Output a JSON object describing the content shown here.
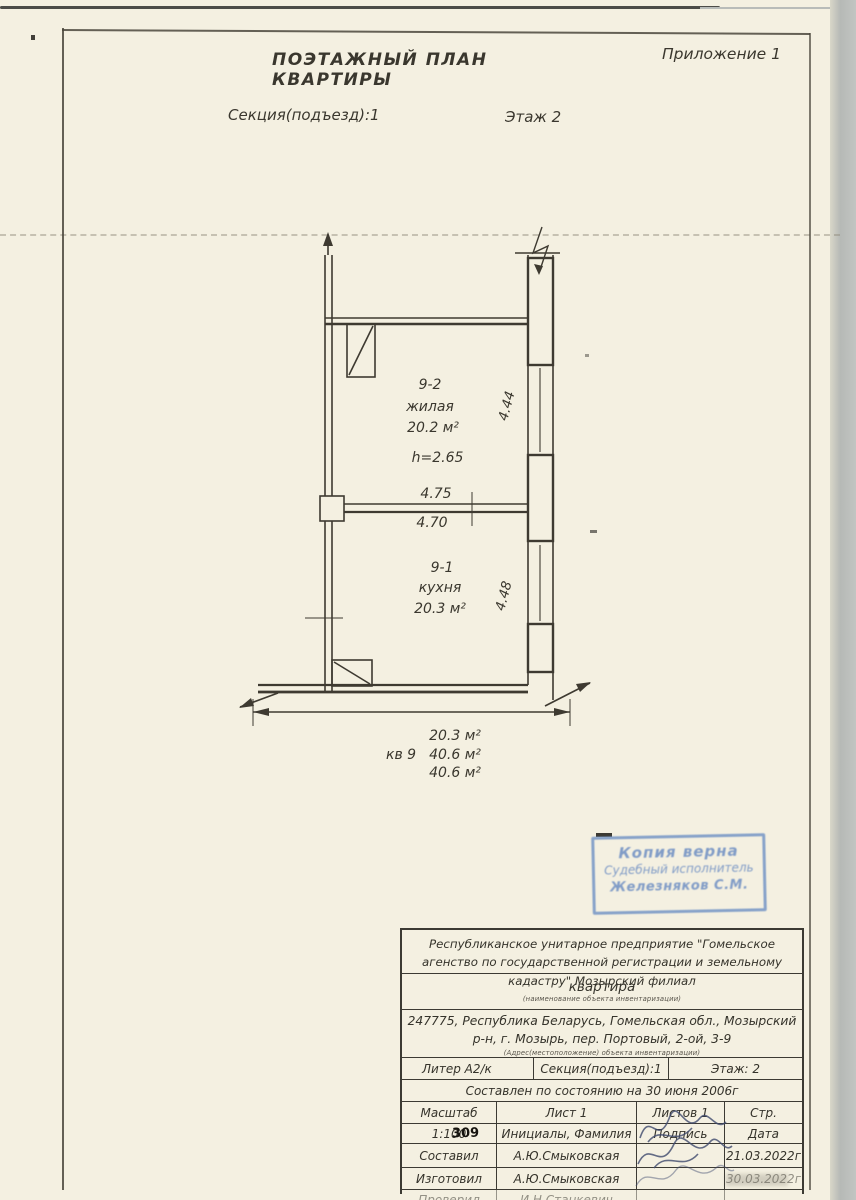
{
  "header": {
    "annex": "Приложение 1",
    "title": "ПОЭТАЖНЫЙ ПЛАН КВАРТИРЫ",
    "section": "Секция(подъезд):1",
    "floor": "Этаж 2"
  },
  "plan": {
    "room_top": {
      "number": "9-2",
      "name": "жилая",
      "area": "20.2 м²",
      "ceiling_height": "h=2.65"
    },
    "room_bottom": {
      "number": "9-1",
      "name": "кухня",
      "area": "20.3 м²"
    },
    "dimensions": {
      "partition_top": "4.75",
      "partition_bottom": "4.70",
      "right_upper": "4.44",
      "right_lower": "4.48"
    },
    "totals": {
      "kitchen_area": "20.3 м²",
      "apartment_label": "кв 9",
      "apartment_area": "40.6 м²",
      "total_area": "40.6 м²"
    }
  },
  "stamp": {
    "line1": "Копия верна",
    "line2": "Судебный исполнитель",
    "line3": "Железняков С.М.",
    "ink_color": "#7e9cc8"
  },
  "info_table": {
    "organization": "Республиканское унитарное предприятие \"Гомельское агенство по государственной регистрации и земельному кадастру\" Мозырский филиал",
    "object_type": "квартира",
    "object_type_caption": "(наименование объекта инвентаризации)",
    "address": "247775, Республика Беларусь, Гомельская обл., Мозырский р-н, г. Мозырь, пер. Портовый, 2-ой, 3-9",
    "address_caption": "(Адрес(местоположение) объекта инвентаризации)",
    "liter": "Литер А2/к",
    "section": "Секция(подъезд):1",
    "floor": "Этаж: 2",
    "status_line": "Составлен по состоянию на 30 июня 2006г",
    "col_headers": {
      "scale": "Масштаб",
      "sheet": "Лист 1",
      "sheets": "Листов 1",
      "page": "Стр."
    },
    "sub_headers": {
      "scale_value": "1:100",
      "initials": "Инициалы, Фамилия",
      "signature": "Подпись",
      "date": "Дата"
    },
    "overprint": "309",
    "rows": [
      {
        "role": "Составил",
        "name": "А.Ю.Смыковская",
        "date": "21.03.2022г"
      },
      {
        "role": "Изготовил",
        "name": "А.Ю.Смыковская",
        "date": "30.03.2022г"
      },
      {
        "role": "Проверил",
        "name": "И.Н.Станкевич",
        "date": ""
      }
    ]
  }
}
